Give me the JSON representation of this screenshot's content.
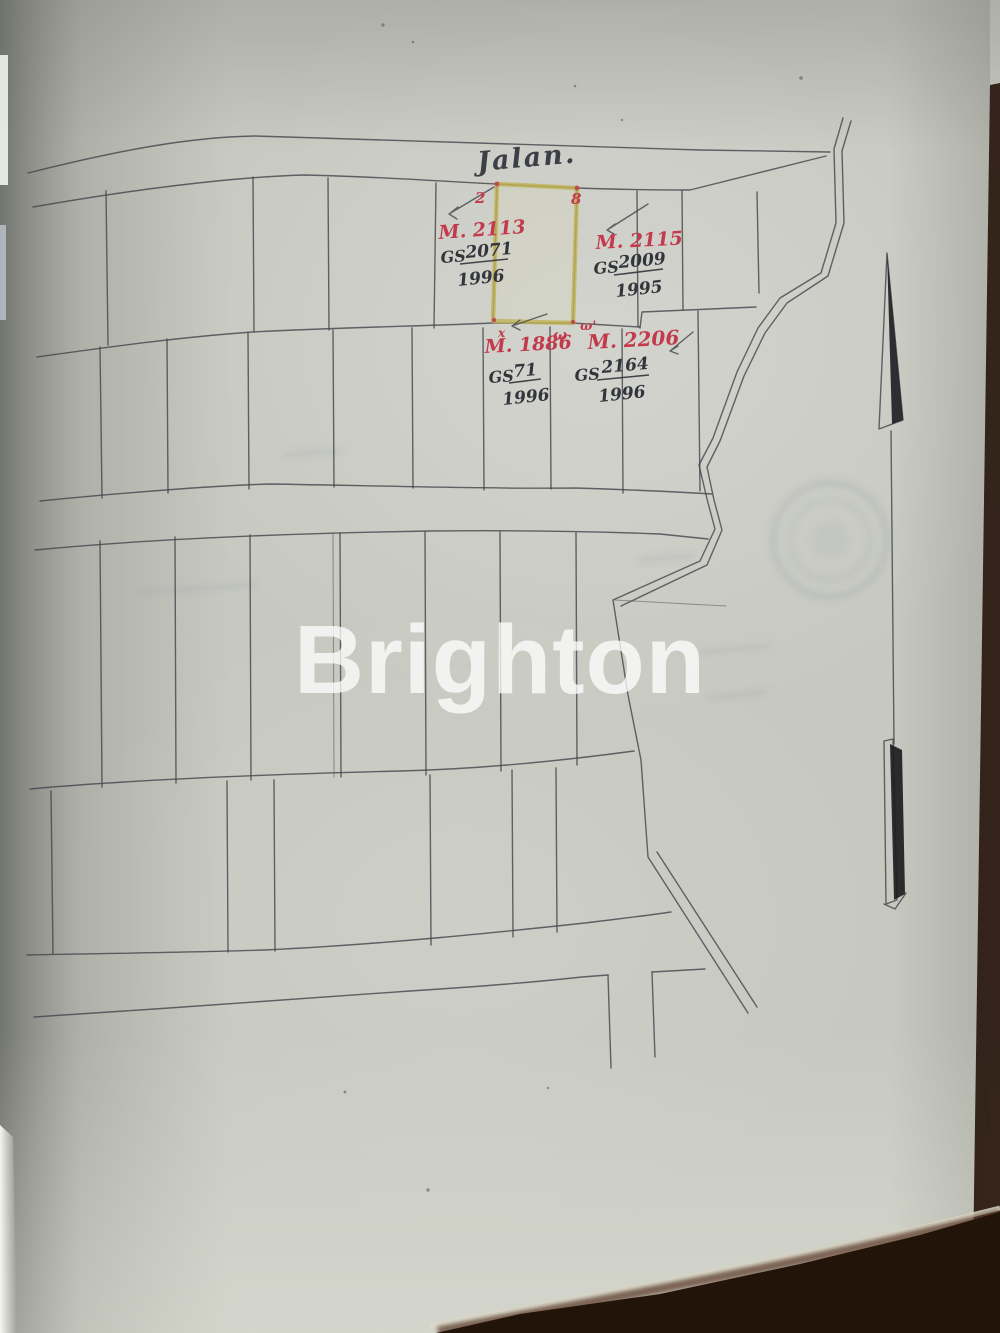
{
  "watermark": "Brighton",
  "map": {
    "road_label": "Jalan.",
    "parcels": [
      {
        "id_label": "M. 2113",
        "gs_label": "GS",
        "gs_number": "2071",
        "gs_year": "1996"
      },
      {
        "id_label": "M. 2115",
        "gs_label": "GS",
        "gs_number": "2009",
        "gs_year": "1995"
      },
      {
        "id_label": "M. 1886",
        "gs_label": "GS",
        "gs_number": "71",
        "gs_year": "1996"
      },
      {
        "id_label": "M. 2206",
        "gs_label": "GS",
        "gs_number": "2164",
        "gs_year": "1996"
      }
    ],
    "corner_marks": {
      "top_left": "2",
      "top_right": "8",
      "bottom_left_sup": "x",
      "bottom_mid": "ω",
      "bottom_right": "ω'"
    }
  }
}
